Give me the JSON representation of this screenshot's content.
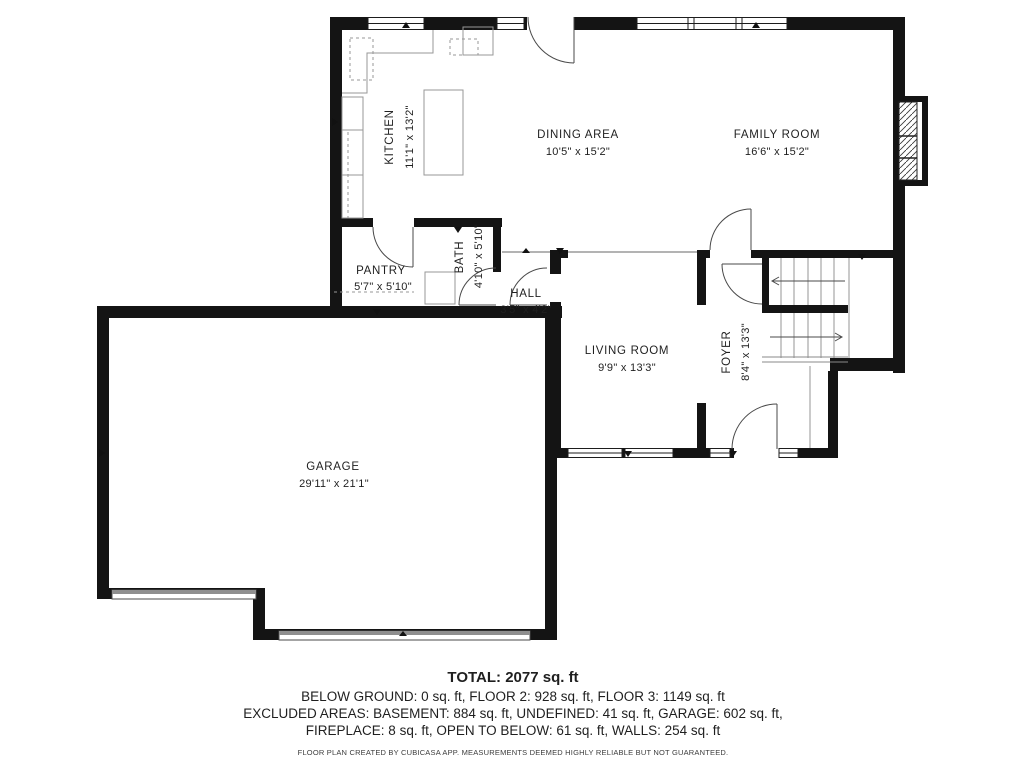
{
  "plan": {
    "rooms": [
      {
        "id": "kitchen",
        "name": "KITCHEN",
        "dims": "11'1\" x 13'2\""
      },
      {
        "id": "dining",
        "name": "DINING AREA",
        "dims": "10'5\" x 15'2\""
      },
      {
        "id": "family",
        "name": "FAMILY ROOM",
        "dims": "16'6\" x 15'2\""
      },
      {
        "id": "pantry",
        "name": "PANTRY",
        "dims": "5'7\" x 5'10\""
      },
      {
        "id": "bath",
        "name": "BATH",
        "dims": "4'10\" x 5'10\""
      },
      {
        "id": "hall",
        "name": "HALL",
        "dims": "3'5\" x 4'2\""
      },
      {
        "id": "living",
        "name": "LIVING ROOM",
        "dims": "9'9\" x 13'3\""
      },
      {
        "id": "foyer",
        "name": "FOYER",
        "dims": "8'4\" x 13'3\""
      },
      {
        "id": "garage",
        "name": "GARAGE",
        "dims": "29'11\" x 21'1\""
      }
    ]
  },
  "summary": {
    "total": "TOTAL: 2077 sq. ft",
    "line1": "BELOW GROUND: 0 sq. ft, FLOOR 2: 928 sq. ft, FLOOR 3: 1149 sq. ft",
    "line2": "EXCLUDED AREAS: BASEMENT: 884 sq. ft, UNDEFINED: 41 sq. ft, GARAGE: 602 sq. ft,",
    "line3": "FIREPLACE: 8 sq. ft, OPEN TO BELOW: 61 sq. ft, WALLS: 254 sq. ft",
    "disclaimer": "FLOOR PLAN CREATED BY CUBICASA APP. MEASUREMENTS DEEMED HIGHLY RELIABLE BUT NOT GUARANTEED."
  },
  "colors": {
    "wall": "#141414",
    "fixture_line": "#979797",
    "door_line": "#4a4a4a",
    "text": "#1f1f1f"
  }
}
